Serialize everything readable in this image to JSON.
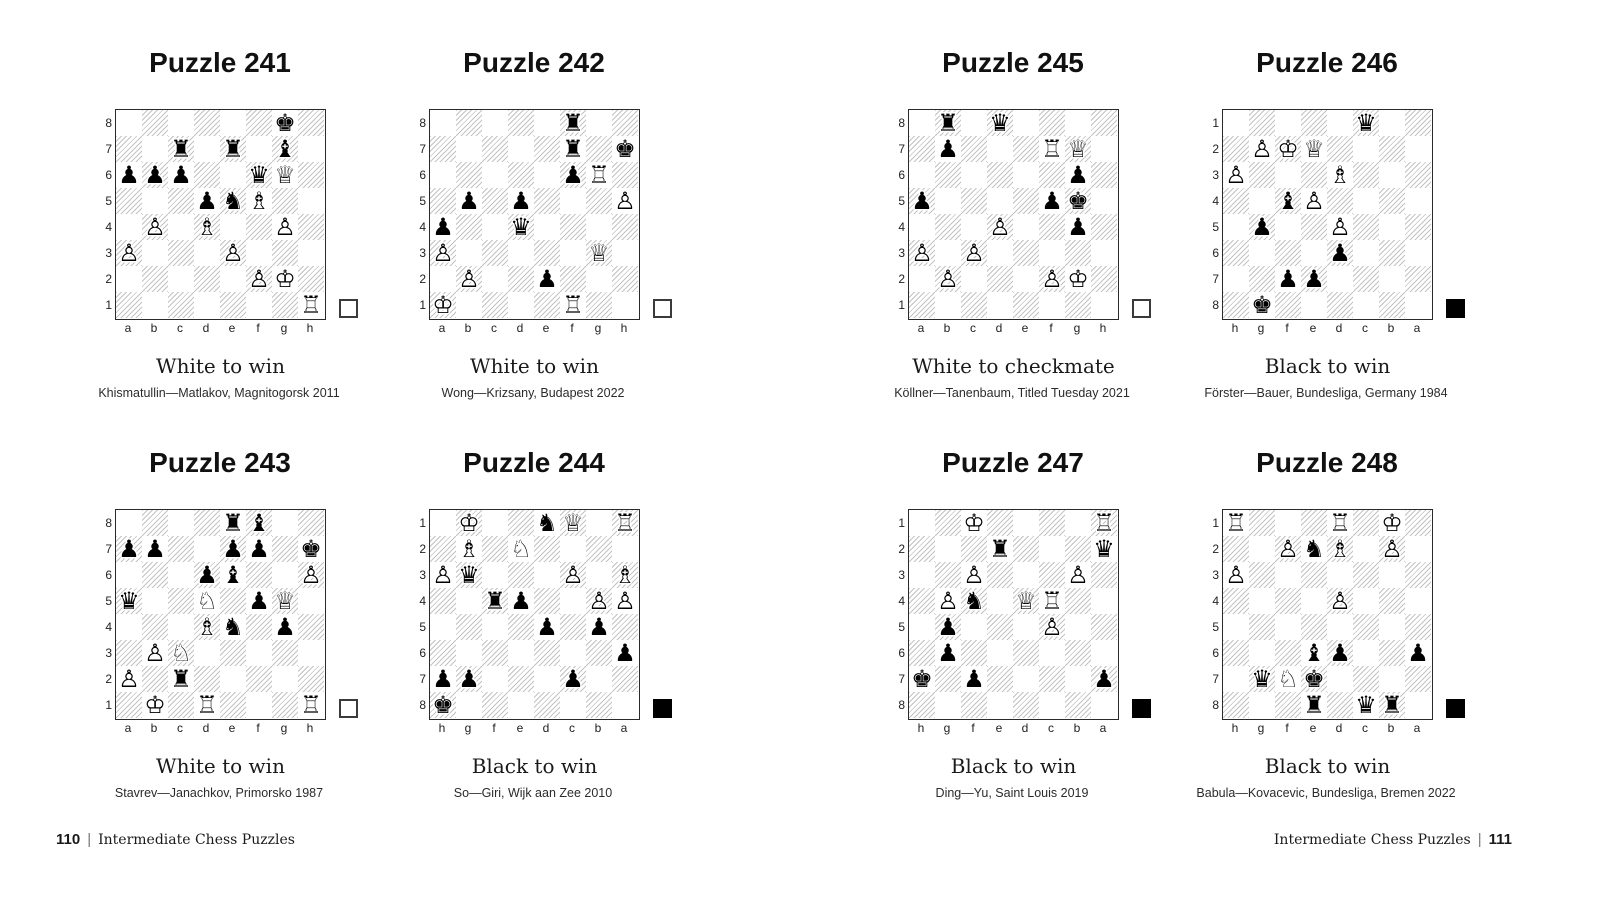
{
  "colors": {
    "background": "#ffffff",
    "dark_square_hatch": "#c3c3c3",
    "board_border": "#2a2a2a",
    "text": "#151515",
    "white_move_indicator": "#ffffff",
    "black_move_indicator": "#000000"
  },
  "piece_glyphs": {
    "wK": "♔",
    "wQ": "♕",
    "wR": "♖",
    "wB": "♗",
    "wN": "♘",
    "wP": "♙",
    "bK": "♚",
    "bQ": "♛",
    "bR": "♜",
    "bB": "♝",
    "bN": "♞",
    "bP": "♟"
  },
  "piece_names": {
    "wK": "white-king-icon",
    "wQ": "white-queen-icon",
    "wR": "white-rook-icon",
    "wB": "white-bishop-icon",
    "wN": "white-knight-icon",
    "wP": "white-pawn-icon",
    "bK": "black-king-icon",
    "bQ": "black-queen-icon",
    "bR": "black-rook-icon",
    "bB": "black-bishop-icon",
    "bN": "black-knight-icon",
    "bP": "black-pawn-icon"
  },
  "footer_left": {
    "page_number": "110",
    "separator": "|",
    "title": "Intermediate Chess Puzzles"
  },
  "footer_right": {
    "page_number": "111",
    "separator": "|",
    "title": "Intermediate Chess Puzzles"
  },
  "pages": [
    {
      "side": "left",
      "puzzles": [
        {
          "title": "Puzzle 241",
          "caption": "White to win",
          "attribution": "Khismatullin—Matlakov, Magnitogorsk 2011",
          "side_to_move": "white",
          "rank_labels": [
            "8",
            "7",
            "6",
            "5",
            "4",
            "3",
            "2",
            "1"
          ],
          "file_labels": [
            "a",
            "b",
            "c",
            "d",
            "e",
            "f",
            "g",
            "h"
          ],
          "pieces": [
            {
              "square": "g8",
              "piece": "bK"
            },
            {
              "square": "c7",
              "piece": "bR"
            },
            {
              "square": "e7",
              "piece": "bR"
            },
            {
              "square": "g7",
              "piece": "bB"
            },
            {
              "square": "a6",
              "piece": "bP"
            },
            {
              "square": "b6",
              "piece": "bP"
            },
            {
              "square": "c6",
              "piece": "bP"
            },
            {
              "square": "f6",
              "piece": "bQ"
            },
            {
              "square": "g6",
              "piece": "wQ"
            },
            {
              "square": "d5",
              "piece": "bP"
            },
            {
              "square": "e5",
              "piece": "bN"
            },
            {
              "square": "f5",
              "piece": "wB"
            },
            {
              "square": "b4",
              "piece": "wP"
            },
            {
              "square": "d4",
              "piece": "wB"
            },
            {
              "square": "g4",
              "piece": "wP"
            },
            {
              "square": "a3",
              "piece": "wP"
            },
            {
              "square": "e3",
              "piece": "wP"
            },
            {
              "square": "f2",
              "piece": "wP"
            },
            {
              "square": "g2",
              "piece": "wK"
            },
            {
              "square": "h1",
              "piece": "wR"
            }
          ]
        },
        {
          "title": "Puzzle 242",
          "caption": "White to win",
          "attribution": "Wong—Krizsany, Budapest 2022",
          "side_to_move": "white",
          "rank_labels": [
            "8",
            "7",
            "6",
            "5",
            "4",
            "3",
            "2",
            "1"
          ],
          "file_labels": [
            "a",
            "b",
            "c",
            "d",
            "e",
            "f",
            "g",
            "h"
          ],
          "pieces": [
            {
              "square": "f8",
              "piece": "bR"
            },
            {
              "square": "f7",
              "piece": "bR"
            },
            {
              "square": "h7",
              "piece": "bK"
            },
            {
              "square": "f6",
              "piece": "bP"
            },
            {
              "square": "g6",
              "piece": "wR"
            },
            {
              "square": "b5",
              "piece": "bP"
            },
            {
              "square": "d5",
              "piece": "bP"
            },
            {
              "square": "h5",
              "piece": "wP"
            },
            {
              "square": "a4",
              "piece": "bP"
            },
            {
              "square": "d4",
              "piece": "bQ"
            },
            {
              "square": "a3",
              "piece": "wP"
            },
            {
              "square": "g3",
              "piece": "wQ"
            },
            {
              "square": "b2",
              "piece": "wP"
            },
            {
              "square": "e2",
              "piece": "bP"
            },
            {
              "square": "a1",
              "piece": "wK"
            },
            {
              "square": "f1",
              "piece": "wR"
            }
          ]
        },
        {
          "title": "Puzzle 243",
          "caption": "White to win",
          "attribution": "Stavrev—Janachkov, Primorsko 1987",
          "side_to_move": "white",
          "rank_labels": [
            "8",
            "7",
            "6",
            "5",
            "4",
            "3",
            "2",
            "1"
          ],
          "file_labels": [
            "a",
            "b",
            "c",
            "d",
            "e",
            "f",
            "g",
            "h"
          ],
          "pieces": [
            {
              "square": "e8",
              "piece": "bR"
            },
            {
              "square": "f8",
              "piece": "bB"
            },
            {
              "square": "a7",
              "piece": "bP"
            },
            {
              "square": "b7",
              "piece": "bP"
            },
            {
              "square": "e7",
              "piece": "bP"
            },
            {
              "square": "f7",
              "piece": "bP"
            },
            {
              "square": "h7",
              "piece": "bK"
            },
            {
              "square": "d6",
              "piece": "bP"
            },
            {
              "square": "e6",
              "piece": "bB"
            },
            {
              "square": "h6",
              "piece": "wP"
            },
            {
              "square": "a5",
              "piece": "bQ"
            },
            {
              "square": "d5",
              "piece": "wN"
            },
            {
              "square": "f5",
              "piece": "bP"
            },
            {
              "square": "g5",
              "piece": "wQ"
            },
            {
              "square": "d4",
              "piece": "wB"
            },
            {
              "square": "e4",
              "piece": "bN"
            },
            {
              "square": "g4",
              "piece": "bP"
            },
            {
              "square": "b3",
              "piece": "wP"
            },
            {
              "square": "c3",
              "piece": "wN"
            },
            {
              "square": "a2",
              "piece": "wP"
            },
            {
              "square": "c2",
              "piece": "bR"
            },
            {
              "square": "b1",
              "piece": "wK"
            },
            {
              "square": "d1",
              "piece": "wR"
            },
            {
              "square": "h1",
              "piece": "wR"
            }
          ]
        },
        {
          "title": "Puzzle 244",
          "caption": "Black to win",
          "attribution": "So—Giri, Wijk aan Zee 2010",
          "side_to_move": "black",
          "rank_labels": [
            "1",
            "2",
            "3",
            "4",
            "5",
            "6",
            "7",
            "8"
          ],
          "file_labels": [
            "h",
            "g",
            "f",
            "e",
            "d",
            "c",
            "b",
            "a"
          ],
          "pieces": [
            {
              "square": "g1",
              "piece": "wK"
            },
            {
              "square": "d1",
              "piece": "bN"
            },
            {
              "square": "c1",
              "piece": "wQ"
            },
            {
              "square": "a1",
              "piece": "wR"
            },
            {
              "square": "g2",
              "piece": "wB"
            },
            {
              "square": "e2",
              "piece": "wN"
            },
            {
              "square": "h3",
              "piece": "wP"
            },
            {
              "square": "g3",
              "piece": "bQ"
            },
            {
              "square": "c3",
              "piece": "wP"
            },
            {
              "square": "a3",
              "piece": "wB"
            },
            {
              "square": "f4",
              "piece": "bR"
            },
            {
              "square": "e4",
              "piece": "bP"
            },
            {
              "square": "b4",
              "piece": "wP"
            },
            {
              "square": "a4",
              "piece": "wP"
            },
            {
              "square": "d5",
              "piece": "bP"
            },
            {
              "square": "b5",
              "piece": "bP"
            },
            {
              "square": "a6",
              "piece": "bP"
            },
            {
              "square": "h7",
              "piece": "bP"
            },
            {
              "square": "g7",
              "piece": "bP"
            },
            {
              "square": "c7",
              "piece": "bP"
            },
            {
              "square": "h8",
              "piece": "bK"
            }
          ]
        }
      ]
    },
    {
      "side": "right",
      "puzzles": [
        {
          "title": "Puzzle 245",
          "caption": "White to checkmate",
          "attribution": "Köllner—Tanenbaum, Titled Tuesday 2021",
          "side_to_move": "white",
          "rank_labels": [
            "8",
            "7",
            "6",
            "5",
            "4",
            "3",
            "2",
            "1"
          ],
          "file_labels": [
            "a",
            "b",
            "c",
            "d",
            "e",
            "f",
            "g",
            "h"
          ],
          "pieces": [
            {
              "square": "b8",
              "piece": "bR"
            },
            {
              "square": "d8",
              "piece": "bQ"
            },
            {
              "square": "b7",
              "piece": "bP"
            },
            {
              "square": "f7",
              "piece": "wR"
            },
            {
              "square": "g7",
              "piece": "wQ"
            },
            {
              "square": "g6",
              "piece": "bP"
            },
            {
              "square": "a5",
              "piece": "bP"
            },
            {
              "square": "f5",
              "piece": "bP"
            },
            {
              "square": "g5",
              "piece": "bK"
            },
            {
              "square": "d4",
              "piece": "wP"
            },
            {
              "square": "g4",
              "piece": "bP"
            },
            {
              "square": "a3",
              "piece": "wP"
            },
            {
              "square": "c3",
              "piece": "wP"
            },
            {
              "square": "b2",
              "piece": "wP"
            },
            {
              "square": "f2",
              "piece": "wP"
            },
            {
              "square": "g2",
              "piece": "wK"
            }
          ]
        },
        {
          "title": "Puzzle 246",
          "caption": "Black to win",
          "attribution": "Förster—Bauer, Bundesliga, Germany 1984",
          "side_to_move": "black",
          "rank_labels": [
            "1",
            "2",
            "3",
            "4",
            "5",
            "6",
            "7",
            "8"
          ],
          "file_labels": [
            "h",
            "g",
            "f",
            "e",
            "d",
            "c",
            "b",
            "a"
          ],
          "pieces": [
            {
              "square": "c1",
              "piece": "bQ"
            },
            {
              "square": "g2",
              "piece": "wP"
            },
            {
              "square": "f2",
              "piece": "wK"
            },
            {
              "square": "e2",
              "piece": "wQ"
            },
            {
              "square": "h3",
              "piece": "wP"
            },
            {
              "square": "d3",
              "piece": "wB"
            },
            {
              "square": "f4",
              "piece": "bB"
            },
            {
              "square": "e4",
              "piece": "wP"
            },
            {
              "square": "g5",
              "piece": "bP"
            },
            {
              "square": "d5",
              "piece": "wP"
            },
            {
              "square": "d6",
              "piece": "bP"
            },
            {
              "square": "f7",
              "piece": "bP"
            },
            {
              "square": "e7",
              "piece": "bP"
            },
            {
              "square": "g8",
              "piece": "bK"
            }
          ]
        },
        {
          "title": "Puzzle 247",
          "caption": "Black to win",
          "attribution": "Ding—Yu, Saint Louis 2019",
          "side_to_move": "black",
          "rank_labels": [
            "1",
            "2",
            "3",
            "4",
            "5",
            "6",
            "7",
            "8"
          ],
          "file_labels": [
            "h",
            "g",
            "f",
            "e",
            "d",
            "c",
            "b",
            "a"
          ],
          "pieces": [
            {
              "square": "f1",
              "piece": "wK"
            },
            {
              "square": "a1",
              "piece": "wR"
            },
            {
              "square": "e2",
              "piece": "bR"
            },
            {
              "square": "a2",
              "piece": "bQ"
            },
            {
              "square": "f3",
              "piece": "wP"
            },
            {
              "square": "b3",
              "piece": "wP"
            },
            {
              "square": "g4",
              "piece": "wP"
            },
            {
              "square": "f4",
              "piece": "bN"
            },
            {
              "square": "d4",
              "piece": "wQ"
            },
            {
              "square": "c4",
              "piece": "wR"
            },
            {
              "square": "g5",
              "piece": "bP"
            },
            {
              "square": "c5",
              "piece": "wP"
            },
            {
              "square": "g6",
              "piece": "bP"
            },
            {
              "square": "h7",
              "piece": "bK"
            },
            {
              "square": "f7",
              "piece": "bP"
            },
            {
              "square": "a7",
              "piece": "bP"
            }
          ]
        },
        {
          "title": "Puzzle 248",
          "caption": "Black to win",
          "attribution": "Babula—Kovacevic, Bundesliga, Bremen 2022",
          "side_to_move": "black",
          "rank_labels": [
            "1",
            "2",
            "3",
            "4",
            "5",
            "6",
            "7",
            "8"
          ],
          "file_labels": [
            "h",
            "g",
            "f",
            "e",
            "d",
            "c",
            "b",
            "a"
          ],
          "pieces": [
            {
              "square": "h1",
              "piece": "wR"
            },
            {
              "square": "d1",
              "piece": "wR"
            },
            {
              "square": "b1",
              "piece": "wK"
            },
            {
              "square": "f2",
              "piece": "wP"
            },
            {
              "square": "e2",
              "piece": "bN"
            },
            {
              "square": "d2",
              "piece": "wB"
            },
            {
              "square": "b2",
              "piece": "wP"
            },
            {
              "square": "h3",
              "piece": "wP"
            },
            {
              "square": "d4",
              "piece": "wP"
            },
            {
              "square": "e6",
              "piece": "bB"
            },
            {
              "square": "d6",
              "piece": "bP"
            },
            {
              "square": "a6",
              "piece": "bP"
            },
            {
              "square": "g7",
              "piece": "bQ"
            },
            {
              "square": "f7",
              "piece": "wN"
            },
            {
              "square": "e7",
              "piece": "bK"
            },
            {
              "square": "e8",
              "piece": "bR"
            },
            {
              "square": "c8",
              "piece": "bQ"
            },
            {
              "square": "b8",
              "piece": "bR"
            }
          ]
        }
      ]
    }
  ]
}
